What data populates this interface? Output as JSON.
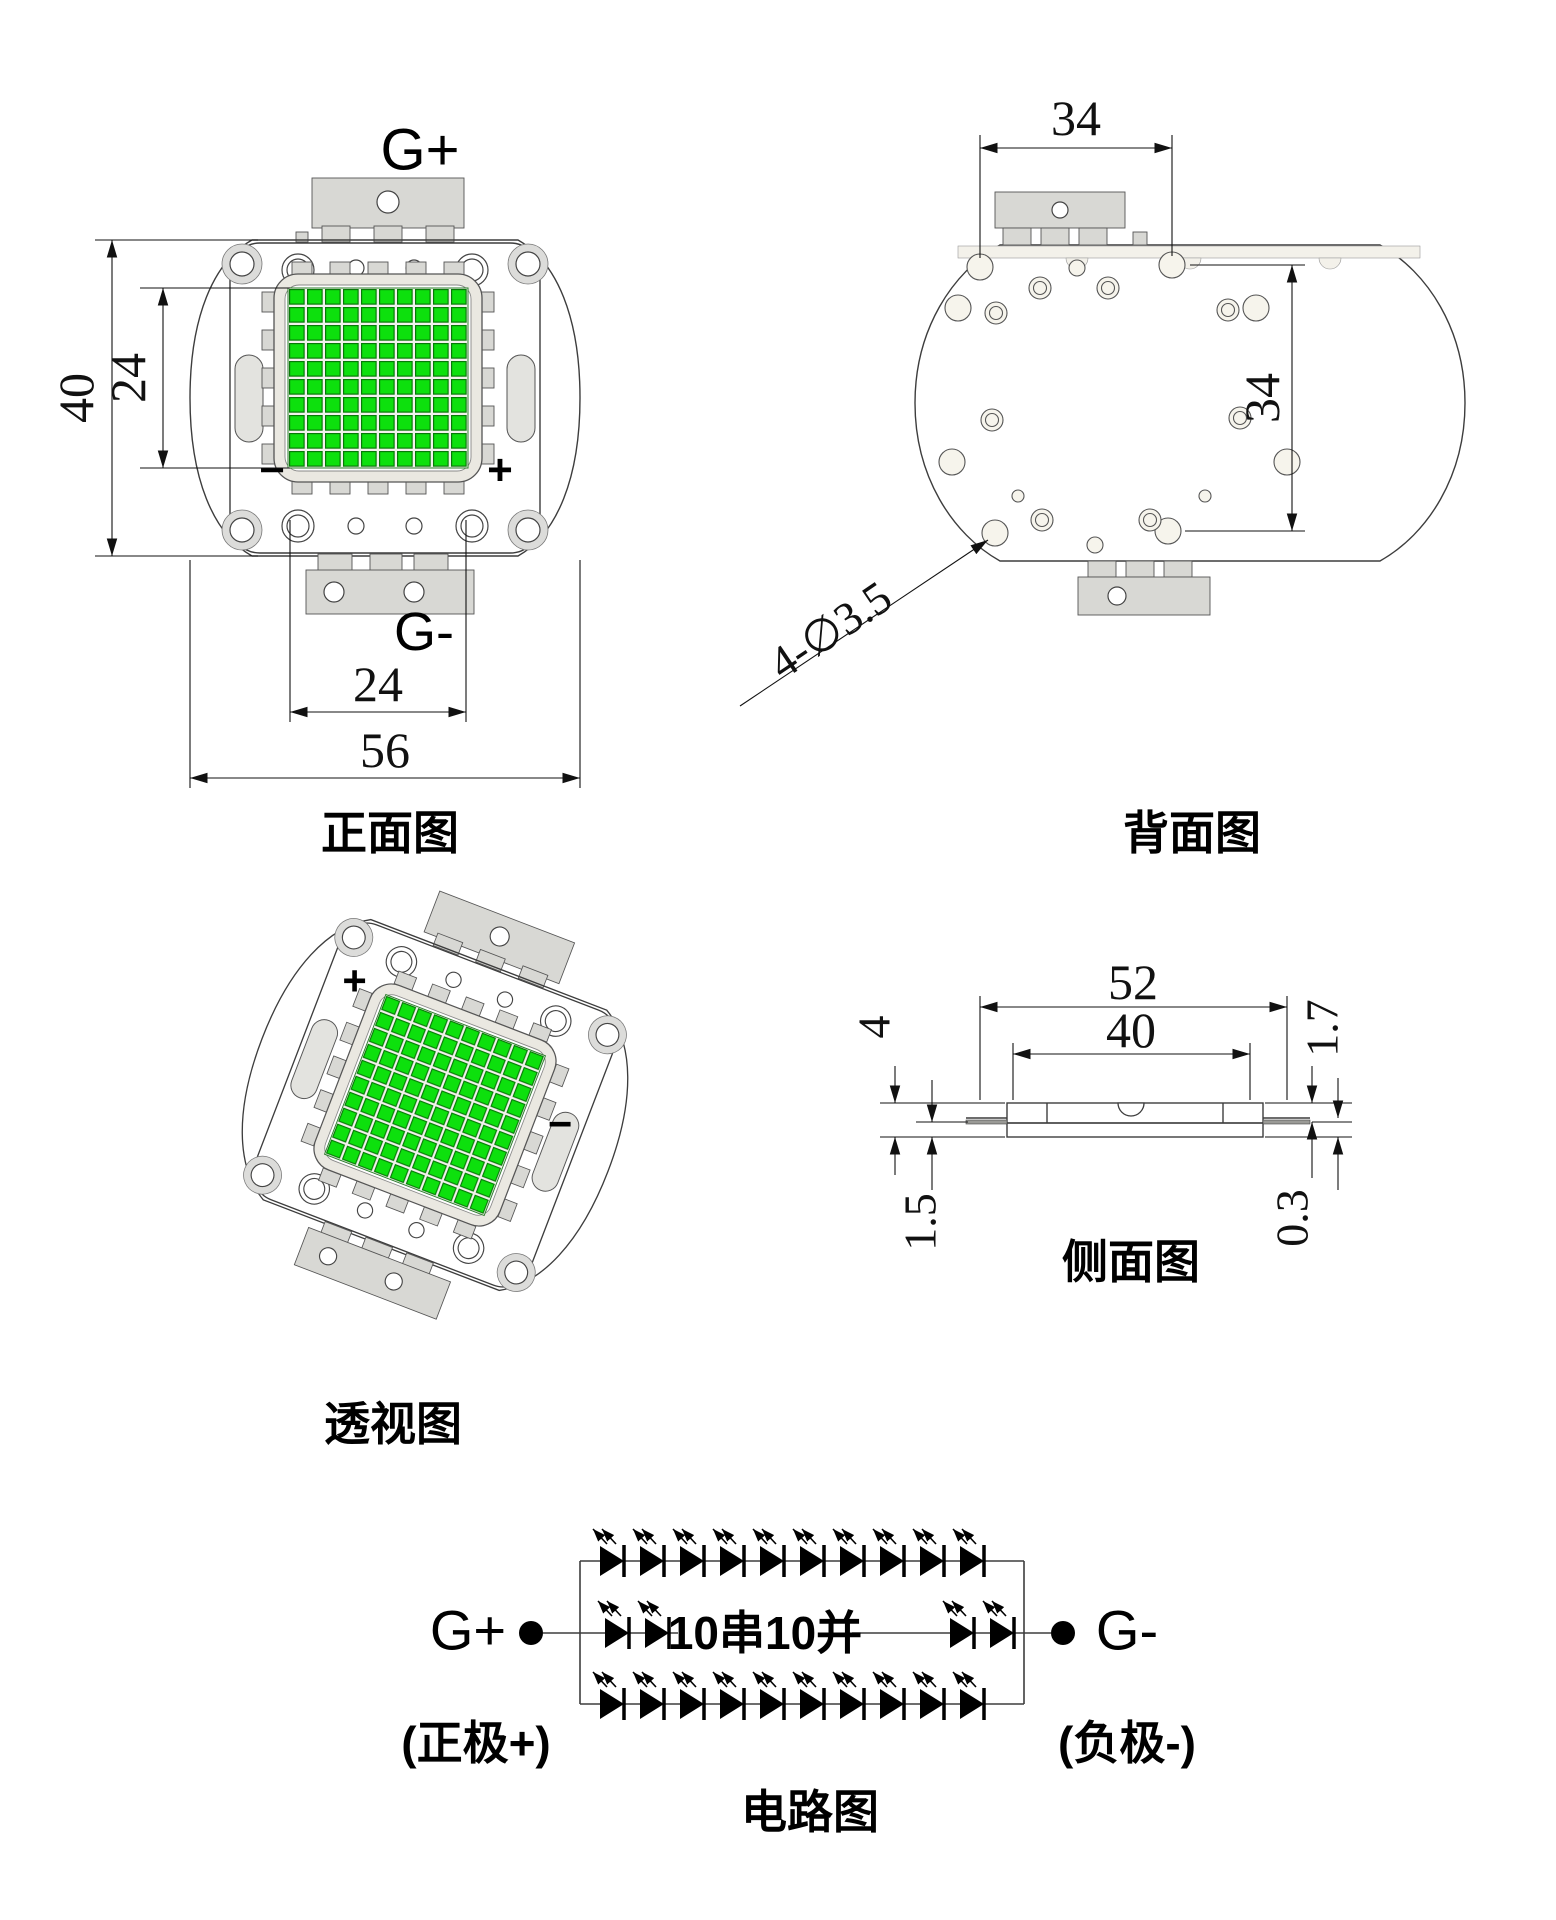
{
  "colors": {
    "led_green": "#0de00d",
    "led_green_border": "#077a07",
    "body_gray": "#dcdcda",
    "plate_white": "#fbfaf5",
    "hole_cream": "#f6f4ec",
    "line_dark": "#3d3d3d"
  },
  "front": {
    "title": "正面图",
    "terminal_top": "G+",
    "terminal_bottom": "G-",
    "plus": "+",
    "minus": "−",
    "dim_height_outer": "40",
    "dim_height_led": "24",
    "dim_width_led": "24",
    "dim_width_outer": "56"
  },
  "back": {
    "title": "背面图",
    "dim_width": "34",
    "dim_height": "34",
    "hole_callout": "4-∅3.5"
  },
  "perspective": {
    "title": "透视图",
    "plus": "+",
    "minus": "−"
  },
  "side": {
    "title": "侧面图",
    "dim_width_outer": "52",
    "dim_width_body": "40",
    "dim_height_total": "4",
    "dim_edge_top": "1.7",
    "dim_height_base": "1.5",
    "dim_lead_thickness": "0.3"
  },
  "circuit": {
    "title": "电路图",
    "terminal_positive": "G+",
    "terminal_negative": "G-",
    "label_positive": "(正极+)",
    "label_negative": "(负极-)",
    "config_label": "10串10并",
    "series_count": 10,
    "parallel_count": 10
  }
}
